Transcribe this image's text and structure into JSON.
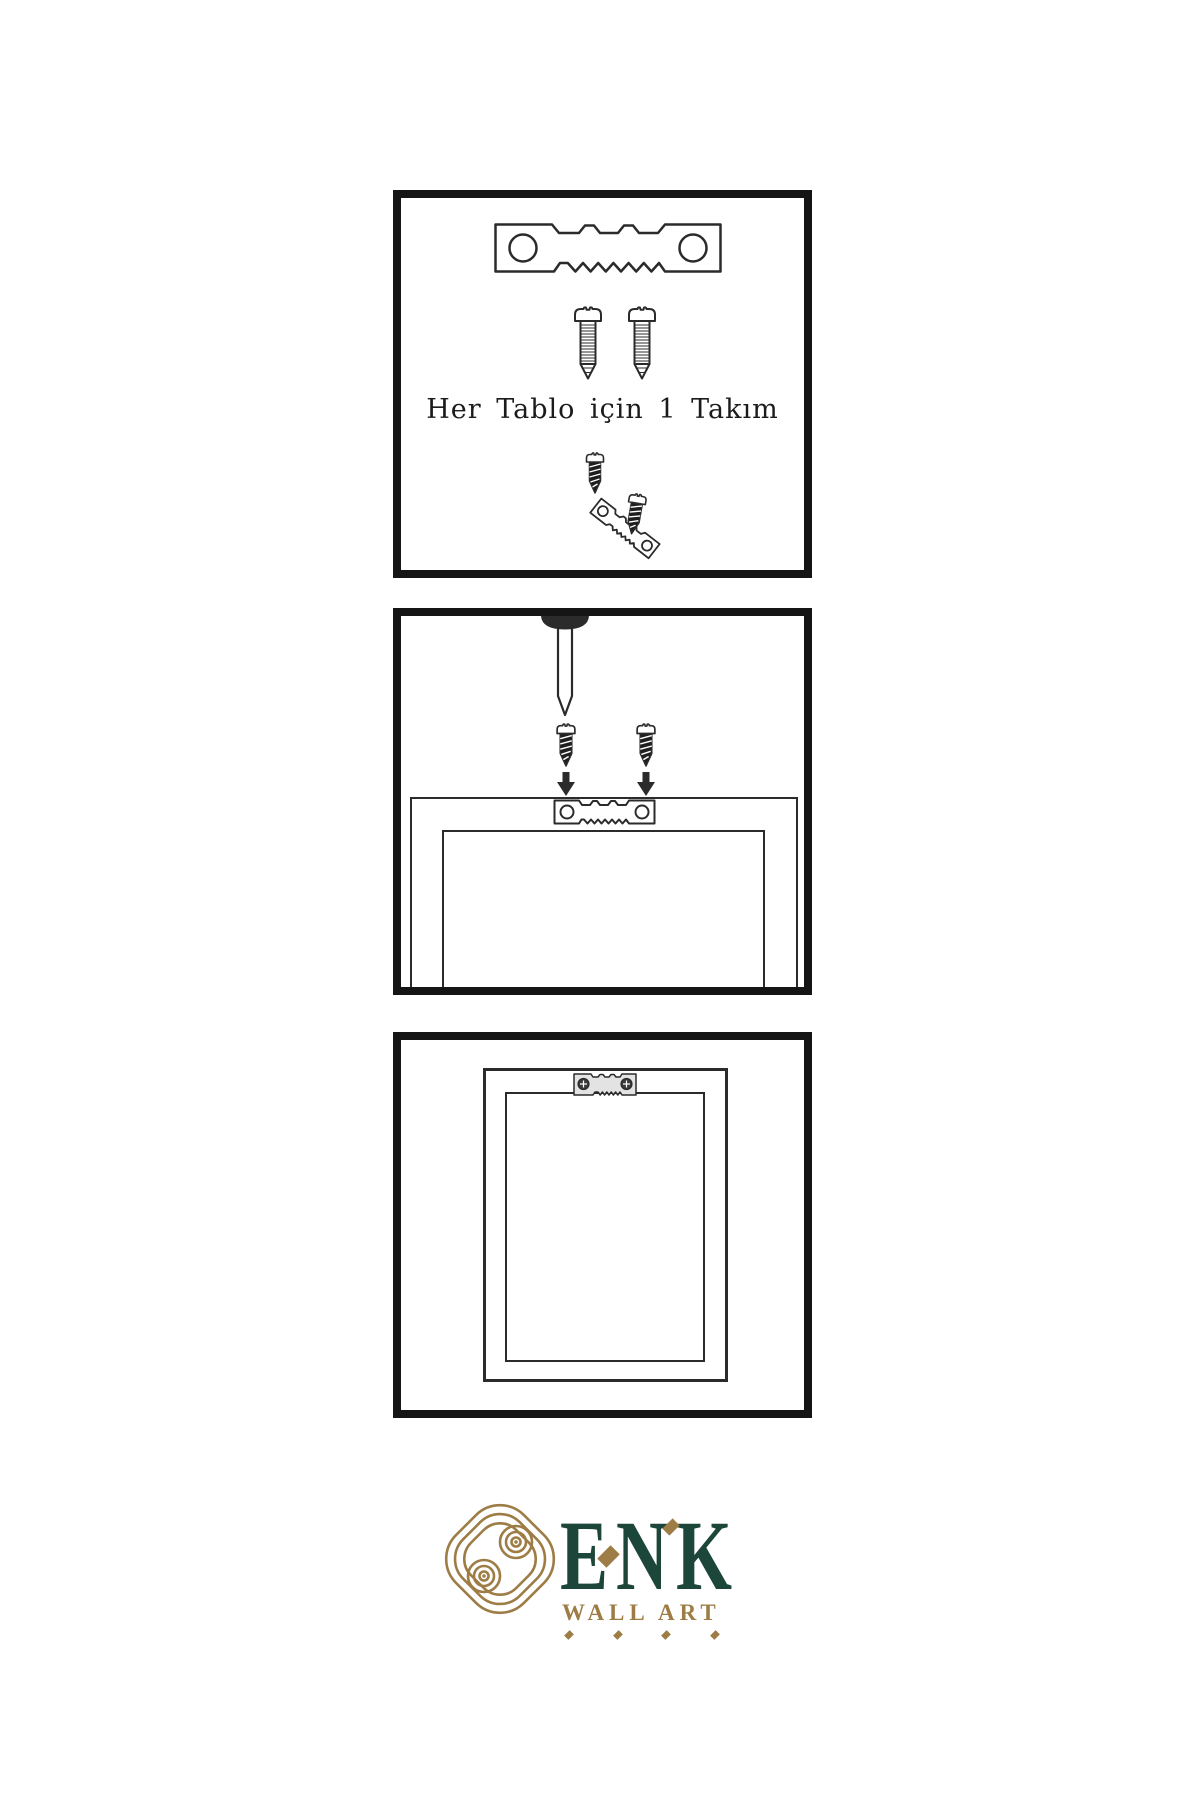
{
  "panels": {
    "kit": {
      "caption": "Her Tablo için 1 Takım",
      "items": [
        "sawtooth-hanger-icon",
        "screw-icon",
        "screw-icon",
        "screw-into-hanger-assembly-icon"
      ]
    },
    "mount": {
      "items": [
        "wall-nail-icon",
        "dark-screw-icon",
        "dark-screw-icon",
        "down-arrow-icon",
        "down-arrow-icon",
        "sawtooth-hanger-icon",
        "frame-back-view"
      ]
    },
    "hang": {
      "items": [
        "framed-picture-front-view",
        "sawtooth-hanger-with-screws-icon"
      ]
    }
  },
  "brand": {
    "name": "ENK",
    "subtitle": "WALL ART",
    "mark": "interlocking-knot-icon"
  },
  "colors": {
    "ink": "#2b2b2b",
    "panel_border": "#151515",
    "dark": "#1e1e1e",
    "logo_gold": "#9d7d45",
    "logo_green": "#1c4639"
  }
}
